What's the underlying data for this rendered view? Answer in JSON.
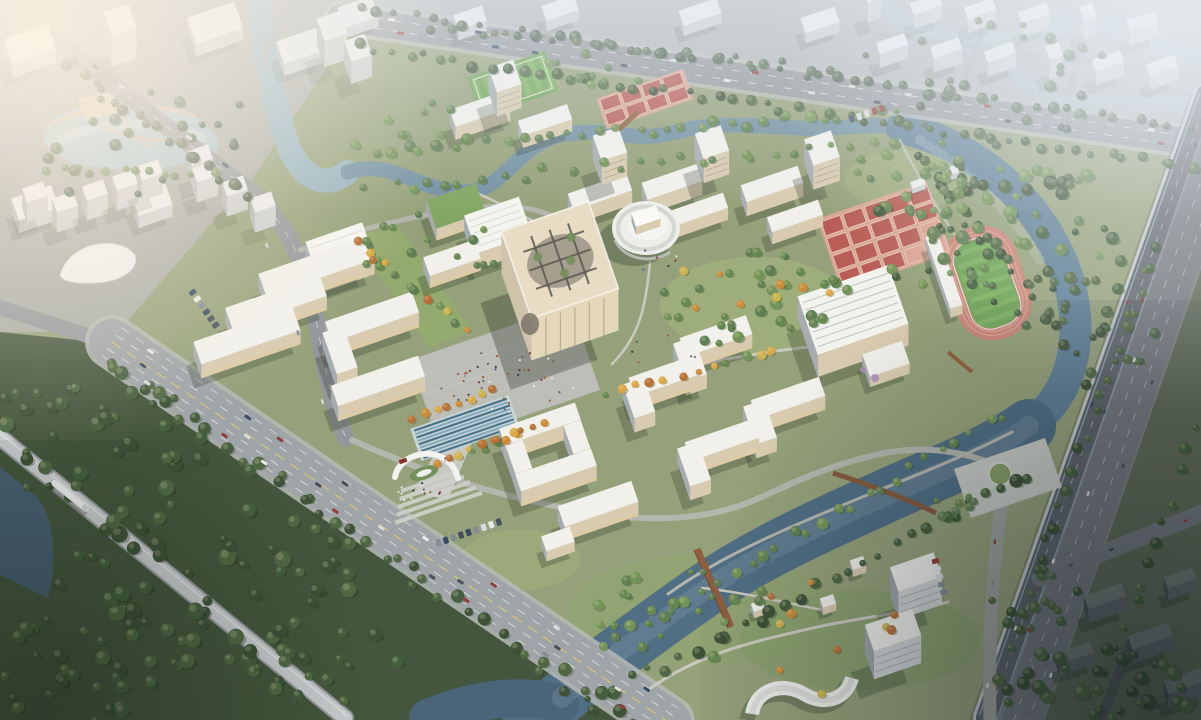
{
  "scene": {
    "type": "natural-image",
    "subject": "aerial architectural rendering of a university campus master plan",
    "view": "bird's-eye three-quarter aerial view",
    "lighting": "hazy warm daylight with sun glow at upper left, dark dusk tones at lower right",
    "visible_text": "none"
  },
  "palette": {
    "ground": "#8f9d74",
    "lawn": "#9fb377",
    "city_tl": "#a4a8a2",
    "city_top": "#aab2b5",
    "city_right": "#55624f",
    "sw_woods": "#394d33",
    "lake": "#a3c0ca",
    "city_river": "#8fb0bd",
    "canal_n": "#6d8da0",
    "canal_e": "#567992",
    "river_s": "#46667f",
    "river_sw": "#3f5d74",
    "pond_dark": "#3d586b",
    "ne_river": "#a9bec8",
    "road": "#8d9297",
    "road_edge": "#b9bdba",
    "boulevard": "#9aa0a5",
    "sidewalk": "#b3b8b5",
    "highway_deck": "#565c64",
    "viaduct_edge": "#c2c7cb",
    "surface_road": "#6b7178",
    "east_road": "#9aa09b",
    "rail": "#c5c9cd",
    "city_road": "#9ba1a4",
    "plaza": "#b9bcb5",
    "paving": "#c4c7c1",
    "track": "#c87f70",
    "track_lane": "#dca497",
    "court": "#b4564e",
    "court_base": "#d8a390",
    "pitch": "#67a04e",
    "pitch_light": "#74ad58",
    "roof": "#f1f1ec",
    "wall_lit": "#d6c9ae",
    "wall_shade": "#a2a8ae",
    "cream": "#e7dcc3",
    "green_roof": "#7ba35c",
    "wood": "#8a5636",
    "tree_dark": "#31492d",
    "tree_mid": "#55794a",
    "autumn": "#c8872f",
    "city_block": "#c6ccd0",
    "city_block_dark": "#3f464a",
    "haze": "#e8eef2",
    "sun_glow": "#fff3e2",
    "pool_stripe": "#3e6d86",
    "flag_red": "#b02a23",
    "blossom": "#a98ab8"
  },
  "features": [
    {
      "name": "main-cube-building",
      "desc": "cream cube hall with circular rooftop lattice garden at the campus centre"
    },
    {
      "name": "oval-auditorium",
      "desc": "white ribbed elliptical hall north-east of the cube"
    },
    {
      "name": "central-plaza",
      "desc": "grey paved plaza with crowds south-west of the cube"
    },
    {
      "name": "striped-water-feature",
      "desc": "band of thin blue reflecting strips between plaza and gate"
    },
    {
      "name": "main-gate",
      "desc": "white crescent arch gate with stepped forecourt on the south-west boulevard"
    },
    {
      "name": "west-teaching-cluster",
      "desc": "parallel slab buildings and U-shaped courtyard block"
    },
    {
      "name": "north-dormitory-groups",
      "desc": "slab buildings with point towers along the north canal"
    },
    {
      "name": "south-east-academic-cluster",
      "desc": "four L-shaped white blocks"
    },
    {
      "name": "gymnasium",
      "desc": "large white hall with skylight strips"
    },
    {
      "name": "athletics-stadium",
      "desc": "pink running track, green infield and white grandstand"
    },
    {
      "name": "basketball-court-grid",
      "desc": "grid of red outdoor courts"
    },
    {
      "name": "north-court-row",
      "desc": "small red courts near the north road"
    },
    {
      "name": "soccer-pitch",
      "desc": "small striped pitch in the north-west corner"
    },
    {
      "name": "campus-canal",
      "desc": "meandering canal looping around the campus"
    },
    {
      "name": "south-river",
      "desc": "wide river with rust pedestrian bridge and timber boardwalk"
    },
    {
      "name": "east-gate-plaza",
      "desc": "paved plaza with circular lawn beside the elevated highway"
    },
    {
      "name": "boulevard",
      "desc": "multi-lane avenue along the south-west edge"
    },
    {
      "name": "elevated-highway",
      "desc": "viaduct and surface road along the east edge"
    },
    {
      "name": "rail-viaduct",
      "desc": "light-rail bridge with a white train in the south-west corner"
    },
    {
      "name": "city-lake-park",
      "desc": "lake with pink shore paths in the hazy top-left city"
    },
    {
      "name": "city-blocks",
      "desc": "hazy apartment rows beyond the north road and to the east"
    },
    {
      "name": "riverside-towers",
      "desc": "white residential towers, pavilions and an S-curved building on the south bank"
    }
  ]
}
